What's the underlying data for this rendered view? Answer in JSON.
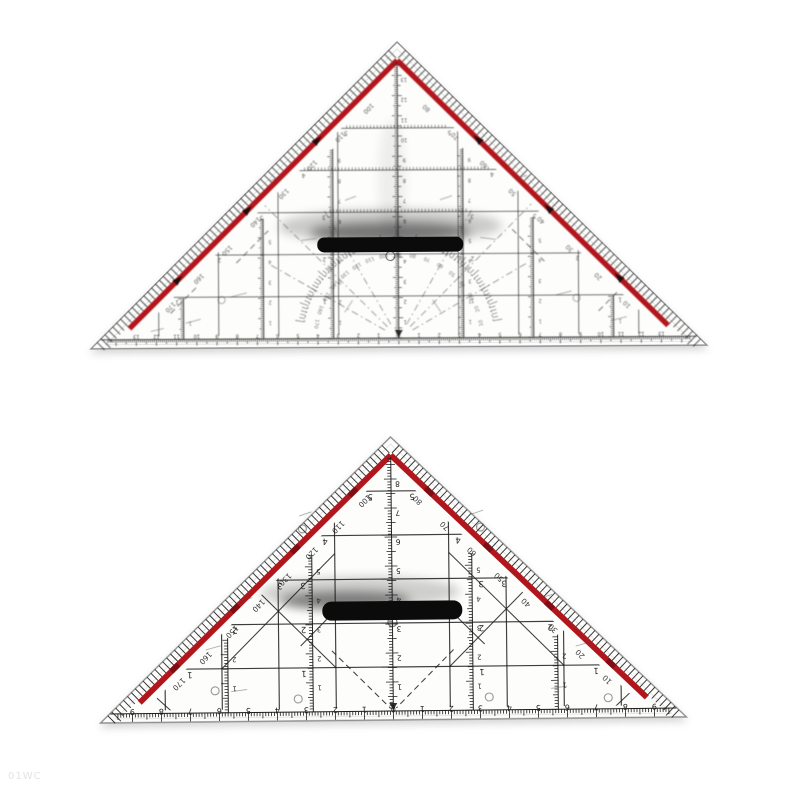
{
  "photo": {
    "background": "#ffffff",
    "watermark": "01WC"
  },
  "colors": {
    "red_stripe": "#b2161d",
    "red_dark": "#7a0d12",
    "ink": "#1c1c1c",
    "body": "#fdfdfc",
    "edge": "#8f9092",
    "handle": "#0b0b0b"
  },
  "top_triangle": {
    "degree_labels_left": [
      "100",
      "110",
      "120",
      "130",
      "140",
      "150",
      "160",
      "170"
    ],
    "degree_labels_right": [
      "80",
      "70",
      "60",
      "50",
      "40",
      "30",
      "20",
      "10"
    ],
    "protractor_labels": [
      "10",
      "20",
      "30",
      "40",
      "50",
      "60",
      "70",
      "80",
      "90",
      "100",
      "110",
      "120",
      "130",
      "140",
      "150",
      "160",
      "170"
    ],
    "base_ruler_numbers": [
      15,
      14,
      13,
      12,
      11,
      10,
      9,
      8,
      7,
      6,
      5,
      4,
      3,
      2,
      1,
      0,
      1,
      2,
      3,
      4,
      5,
      6,
      7,
      8,
      9,
      10,
      11,
      12,
      13,
      14,
      15
    ],
    "center_scale_numbers": [
      1,
      2,
      3,
      4,
      5,
      6,
      7,
      8,
      9,
      10,
      11,
      12,
      13
    ],
    "row_numbers": [
      1,
      2,
      3,
      4,
      5,
      6
    ]
  },
  "bottom_triangle": {
    "degree_labels_left": [
      "100",
      "110",
      "120",
      "130",
      "140",
      "150",
      "160",
      "170"
    ],
    "degree_labels_right": [
      "80",
      "70",
      "60",
      "50",
      "40",
      "30",
      "20",
      "10"
    ],
    "base_ruler_numbers": [
      10,
      9,
      8,
      7,
      6,
      5,
      4,
      3,
      2,
      1,
      0,
      1,
      2,
      3,
      4,
      5,
      6,
      7,
      8,
      9,
      10
    ],
    "center_scale_numbers": [
      1,
      2,
      3,
      4,
      5,
      6,
      7,
      8
    ],
    "row_numbers": [
      1,
      2,
      3,
      4,
      5
    ]
  }
}
